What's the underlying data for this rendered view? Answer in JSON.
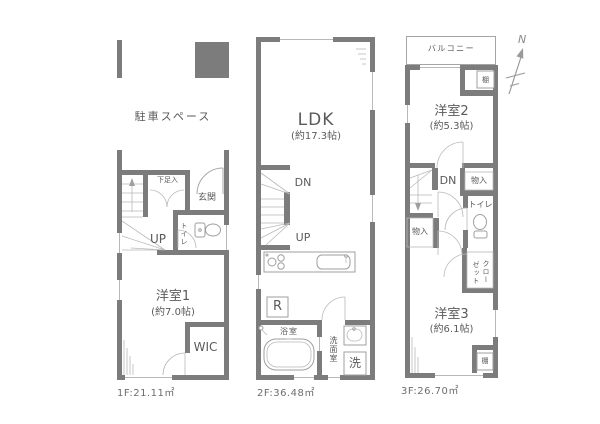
{
  "colors": {
    "wall": "#7c7c7c",
    "thin_line": "#b5b5b5",
    "text": "#5a5a5a"
  },
  "compass": {
    "north": "N"
  },
  "floors": {
    "f1": {
      "area": "1F:21.11㎡",
      "parking": "駐車スペース",
      "shoe_closet": "下足入",
      "entrance": "玄関",
      "toilet": "トイレ",
      "up": "UP",
      "room_name": "洋室1",
      "room_size": "(約7.0帖)",
      "wic": "WIC"
    },
    "f2": {
      "area": "2F:36.48㎡",
      "ldk_name": "LDK",
      "ldk_size": "(約17.3帖)",
      "dn": "DN",
      "up": "UP",
      "fridge": "R",
      "bath": "浴室",
      "washroom": "洗面室",
      "laundry": "洗"
    },
    "f3": {
      "area": "3F:26.70㎡",
      "balcony": "バルコニー",
      "room2_name": "洋室2",
      "room2_size": "(約5.3帖)",
      "dn": "DN",
      "storage_top": "物入",
      "storage_left": "物入",
      "toilet": "トイレ",
      "closet_col1": "クロー",
      "closet_col2": "ゼット",
      "shelf_top": "棚",
      "shelf_bottom": "棚",
      "room3_name": "洋室3",
      "room3_size": "(約6.1帖)"
    }
  }
}
